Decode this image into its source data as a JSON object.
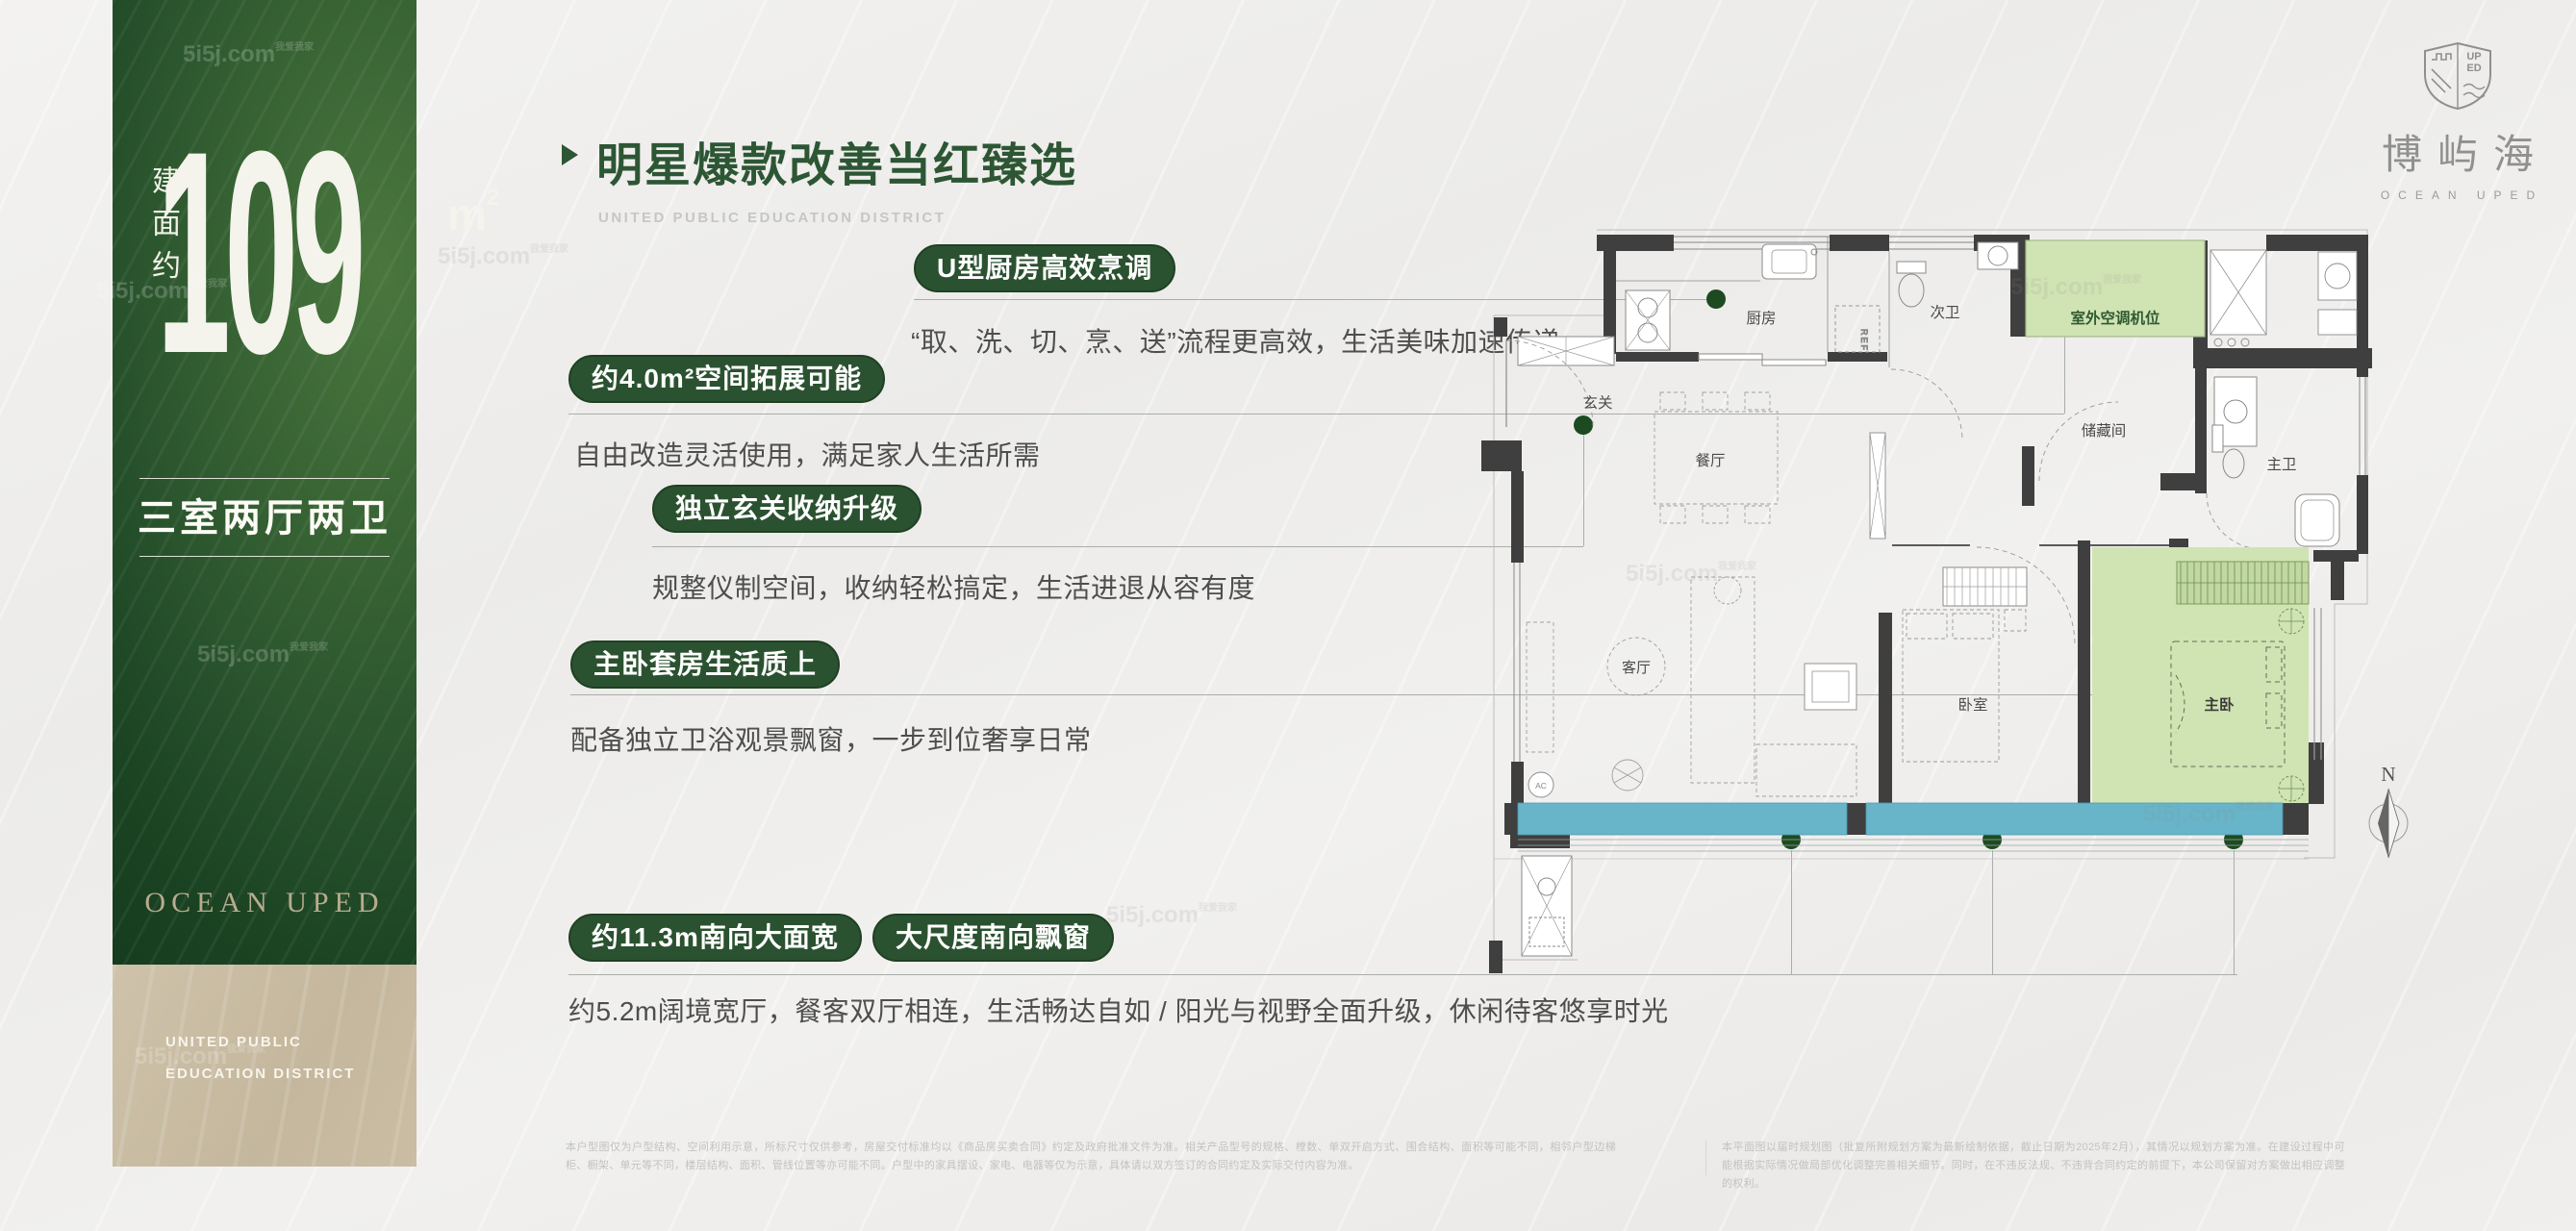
{
  "left_panel": {
    "area_label": "建面约",
    "area_value": "109",
    "area_unit": "m",
    "area_unit_sup": "2",
    "layout": "三室两厅两卫",
    "brand": "OCEAN UPED",
    "district_line1": "UNITED PUBLIC",
    "district_line2": "EDUCATION DISTRICT"
  },
  "header": {
    "title": "明星爆款改善当红臻选",
    "subtitle": "UNITED PUBLIC EDUCATION DISTRICT"
  },
  "sections": [
    {
      "badge": "U型厨房高效烹调",
      "body": "“取、洗、切、烹、送”流程更高效，生活美味加速传递"
    },
    {
      "badge": "约4.0m²空间拓展可能",
      "body": "自由改造灵活使用，满足家人生活所需"
    },
    {
      "badge": "独立玄关收纳升级",
      "body": "规整仪制空间，收纳轻松搞定，生活进退从容有度"
    },
    {
      "badge": "主卧套房生活质上",
      "body": "配备独立卫浴观景飘窗，一步到位奢享日常"
    },
    {
      "badge": "约11.3m南向大面宽",
      "badge2": "大尺度南向飘窗",
      "body": "约5.2m阔境宽厅，餐客双厅相连，生活畅达自如 / 阳光与视野全面升级，休闲待客悠享时光"
    }
  ],
  "floorplan": {
    "rooms": {
      "kitchen": "厨房",
      "bath2": "次卫",
      "ac_platform": "室外空调机位",
      "storage": "储藏间",
      "master_bath": "主卫",
      "foyer": "玄关",
      "dining": "餐厅",
      "living": "客厅",
      "bedroom": "卧室",
      "master": "主卧"
    },
    "labels": {
      "fridge": "REF",
      "ac_unit": "AC",
      "compass": "N"
    }
  },
  "logo": {
    "crest_line1": "UP",
    "crest_line2": "ED",
    "name_cn": "博屿海",
    "name_en": "OCEAN UPED"
  },
  "watermark": {
    "text": "5i5j.com",
    "tag": "我爱我家"
  },
  "disclaimer": {
    "left": "本户型图仅为户型结构、空间利用示意，所标尺寸仅供参考，房屋交付标准均以《商品房买卖合同》约定及政府批准文件为准。相关产品型号的规格、樘数、单双开启方式、围合结构、面积等可能不同，相邻户型边梯柜、橱架、单元等不同，楼层结构、面积、管线位置等亦可能不同。户型中的家具摆设、家电、电器等仅为示意，具体请以双方签订的合同约定及实际交付内容为准。",
    "right": "本平面图以届时规划图（批复所附规划方案为最新绘制依据，截止日期为2025年2月），其情况以规划方案为准。在建设过程中可能根据实际情况做局部优化调整完善相关细节。同时，在不违反法规、不违背合同约定的前提下，本公司保留对方案做出相应调整的权利。"
  },
  "colors": {
    "deep_green": "#2b5230",
    "badge_green": "#2b5230",
    "heading_green": "#2d5634",
    "teal_band": "#68b4c9",
    "highlight_green": "#cfe4b2",
    "beige": "#c8bba1",
    "dot_green": "#1c4a21"
  }
}
